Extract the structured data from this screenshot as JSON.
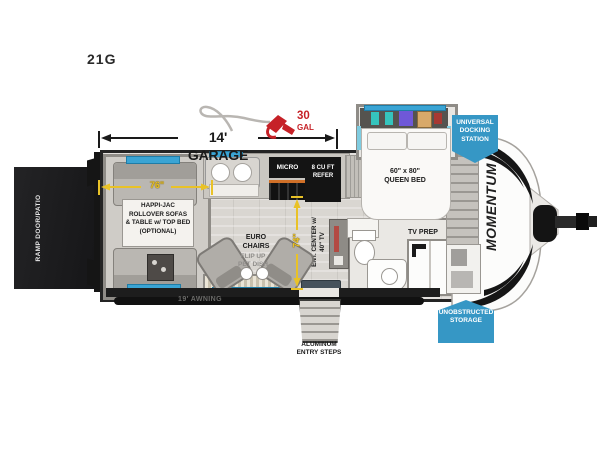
{
  "model": "21G",
  "brand_logo": "MOMENTUM",
  "dimensions": {
    "garage": "14' GARAGE",
    "fuel_value": "30",
    "fuel_unit": "GAL",
    "sofa_width": "76\"",
    "interior_length": "74\"",
    "awning": "19' AWNING"
  },
  "features": {
    "ramp_door": "RAMP DOOR/PATIO",
    "happijac": "HAPPI-JAC\nROLLOVER SOFAS\n& TABLE w/ TOP BED\n(OPTIONAL)",
    "micro": "MICRO",
    "refer": "8 CU FT\nREFER",
    "queen_bed": "60\" x 80\"\nQUEEN BED",
    "euro_chairs": "EURO\nCHAIRS",
    "pet_dish": "FLIP UP\nPET DISH",
    "ent_center": "ENT. CENTER w/\n40\" TV",
    "tv_prep": "TV PREP",
    "entry_steps": "ALUMINUM\nENTRY STEPS"
  },
  "badges": {
    "docking": "UNIVERSAL\nDOCKING\nSTATION",
    "storage": "UNOBSTRUCTED\nSTORAGE"
  },
  "colors": {
    "badge_blue": "#3697c5",
    "dimension_yellow": "#e9c227",
    "fuel_red": "#c62127",
    "window_blue": "#3aa4d4",
    "wall_black": "#1d1d1d"
  }
}
